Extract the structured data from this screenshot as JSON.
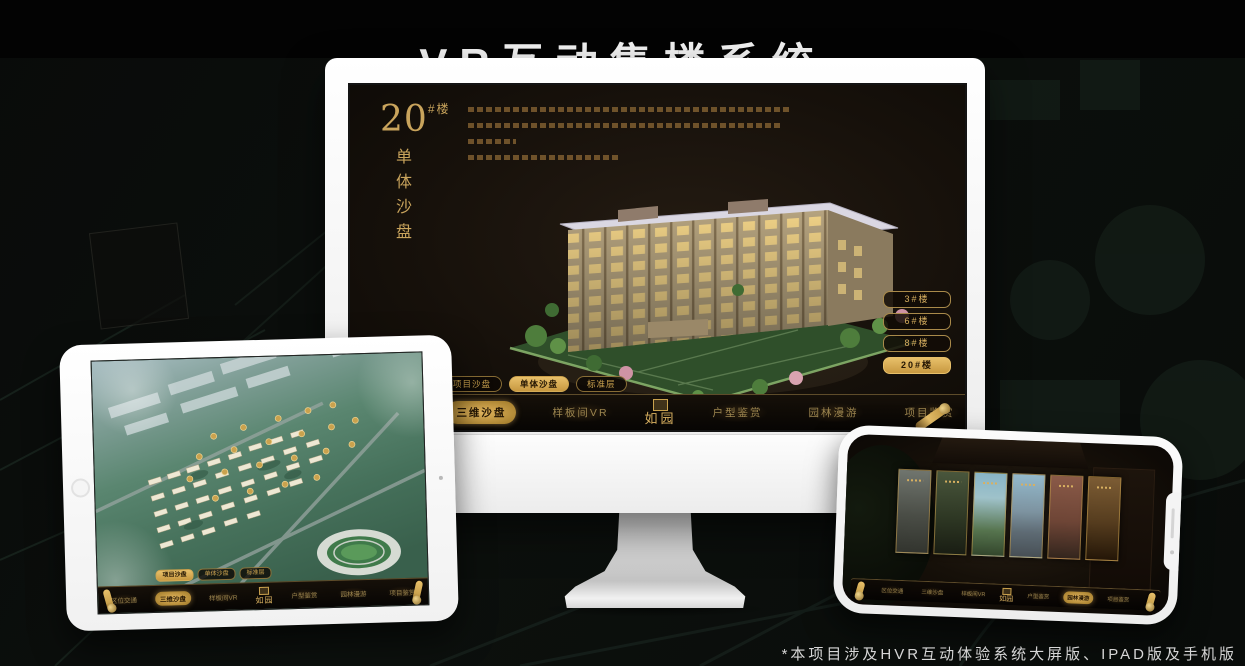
{
  "poster": {
    "title": "VR互动售楼系统",
    "footnote": "*本项目涉及HVR互动体验系统大屏版、IPAD版及手机版"
  },
  "colors": {
    "accent_gold": "#d4a74f",
    "selected_gold": "#e8c06a",
    "screen_bg": "#14100a"
  },
  "desktop": {
    "project_logo": "如园",
    "heading": {
      "number": "20",
      "unit": "#楼",
      "vertical_label": "单体沙盘"
    },
    "floor_buttons": [
      {
        "label": "3#楼",
        "selected": false
      },
      {
        "label": "6#楼",
        "selected": false
      },
      {
        "label": "8#楼",
        "selected": false
      },
      {
        "label": "20#楼",
        "selected": true
      }
    ],
    "sub_tabs": [
      {
        "label": "项目沙盘",
        "selected": false
      },
      {
        "label": "单体沙盘",
        "selected": true
      },
      {
        "label": "标准层",
        "selected": false
      }
    ],
    "menu_items": [
      {
        "label": "区位交通",
        "selected": false
      },
      {
        "label": "三维沙盘",
        "selected": true
      },
      {
        "label": "样板间VR",
        "selected": false
      },
      {
        "label": "户型鉴赏",
        "selected": false
      },
      {
        "label": "园林漫游",
        "selected": false
      },
      {
        "label": "项目鉴赏",
        "selected": false
      }
    ]
  },
  "tablet": {
    "project_logo": "如园",
    "sub_tabs": [
      {
        "label": "项目沙盘",
        "selected": true
      },
      {
        "label": "单体沙盘",
        "selected": false
      },
      {
        "label": "标准层",
        "selected": false
      }
    ],
    "menu_items": [
      {
        "label": "区位交通",
        "selected": false
      },
      {
        "label": "三维沙盘",
        "selected": true
      },
      {
        "label": "样板间VR",
        "selected": false
      },
      {
        "label": "户型鉴赏",
        "selected": false
      },
      {
        "label": "园林漫游",
        "selected": false
      },
      {
        "label": "项目鉴赏",
        "selected": false
      }
    ]
  },
  "phone": {
    "project_logo": "如园",
    "gallery_card_count": 6,
    "menu_items": [
      {
        "label": "区位交通",
        "selected": false
      },
      {
        "label": "三维沙盘",
        "selected": false
      },
      {
        "label": "样板间VR",
        "selected": false
      },
      {
        "label": "户型鉴赏",
        "selected": false
      },
      {
        "label": "园林漫游",
        "selected": true
      },
      {
        "label": "项目鉴赏",
        "selected": false
      }
    ]
  }
}
